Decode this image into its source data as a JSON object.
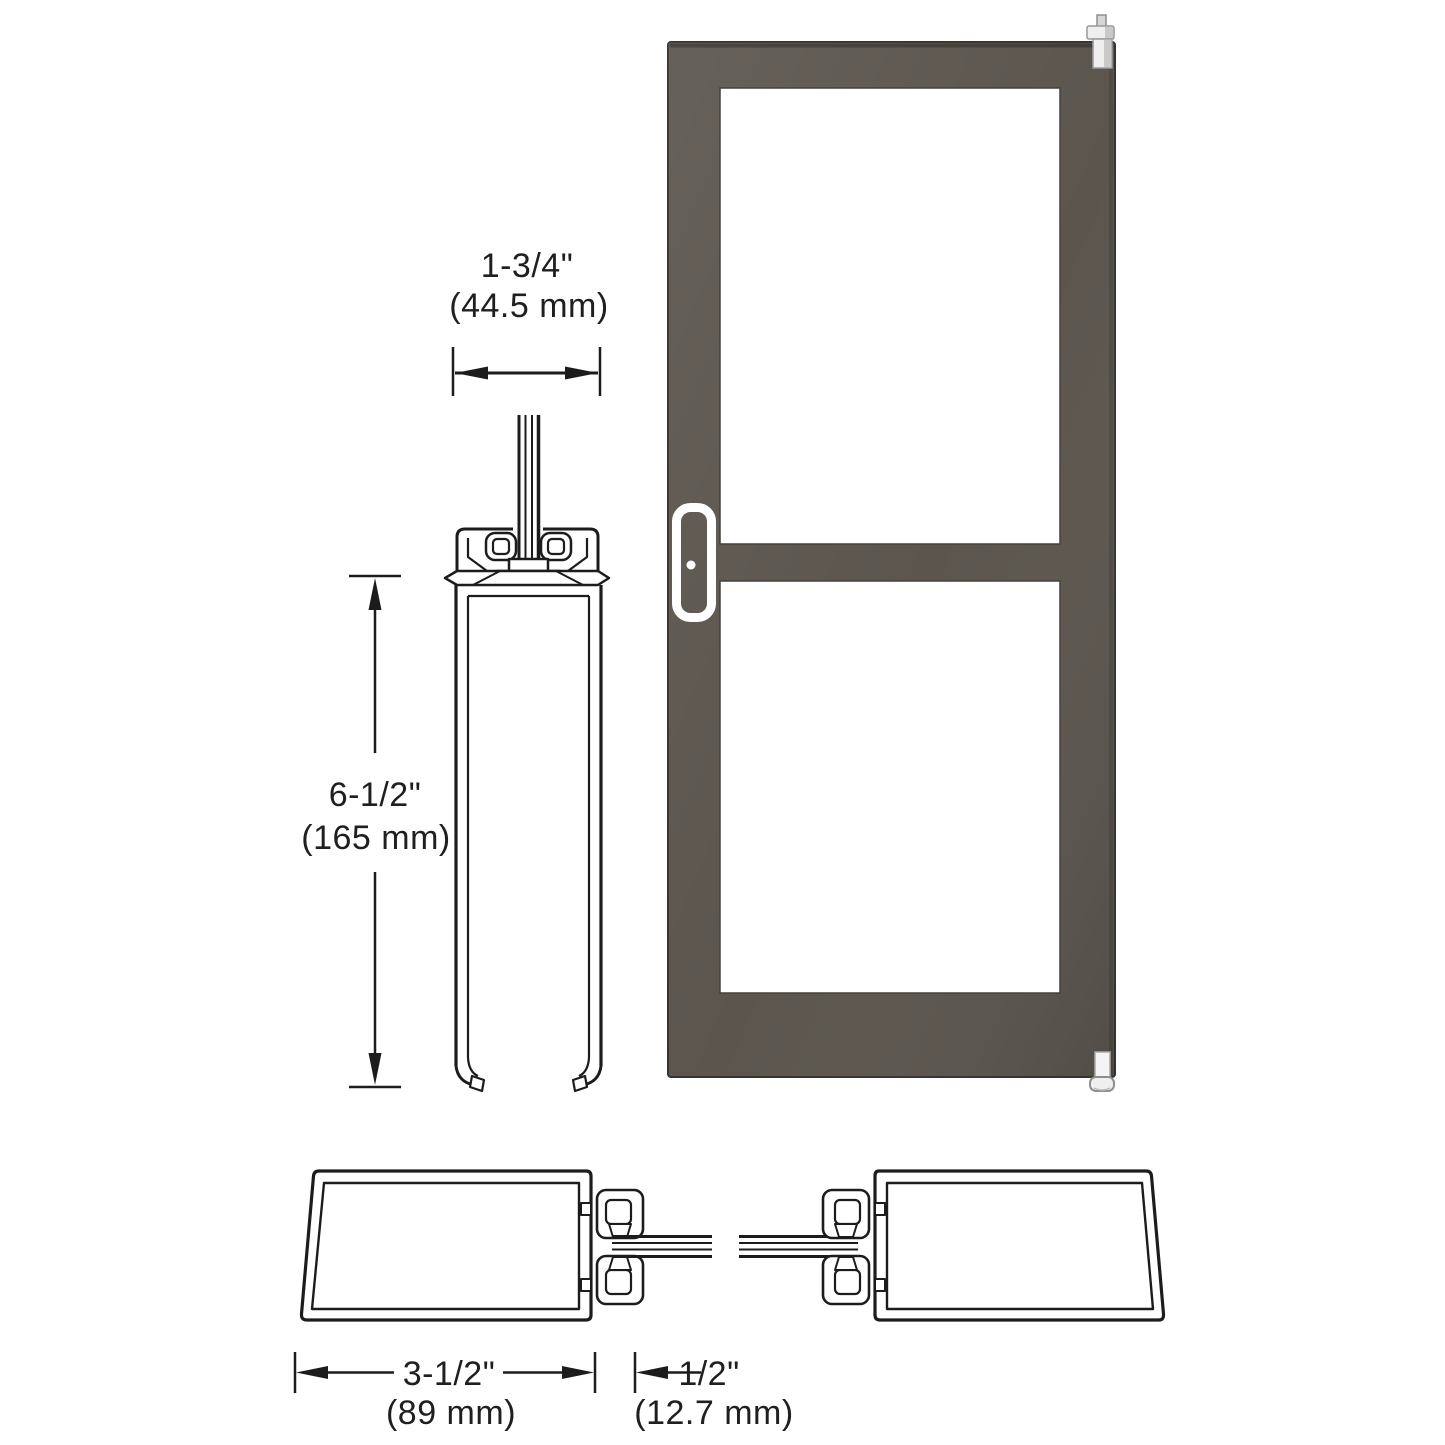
{
  "colors": {
    "line": "#1c1c1c",
    "text": "#1f1f1f",
    "frame": "#5b554e",
    "frame_outline": "#38332d",
    "glass": "#ffffff",
    "handle": "#ffffff",
    "pivot_light": "#efefef",
    "pivot_mid": "#c9c9c9",
    "background": "#ffffff"
  },
  "dimensions": {
    "door_thickness": {
      "inches": "1-3/4\"",
      "mm": "(44.5 mm)"
    },
    "rail_height": {
      "inches": "6-1/2\"",
      "mm": "(165 mm)"
    },
    "stile_face": {
      "inches": "3-1/2\"",
      "mm": "(89 mm)"
    },
    "glass_gap": {
      "inches": "1/2\"",
      "mm": "(12.7 mm)"
    }
  }
}
